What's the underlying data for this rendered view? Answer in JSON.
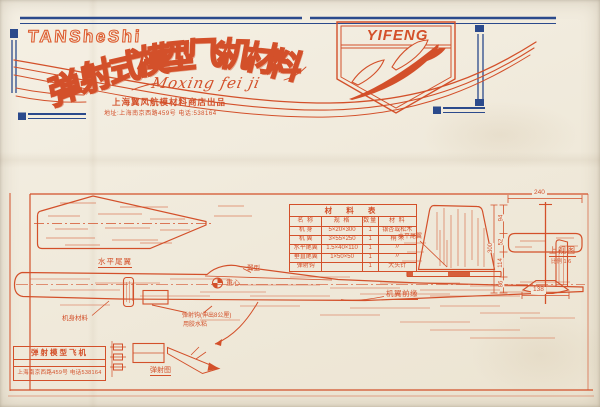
{
  "header": {
    "brand_latin": "TANSheShi",
    "title_cn": "弹射式模型飞机材料",
    "title_chars": [
      "弹",
      "射",
      "式",
      "模",
      "型",
      "飞",
      "机",
      "材",
      "料"
    ],
    "script_latin": "Moxing fei ji",
    "store_line": "上海翼风航模材料商店出品",
    "address_line": "地址:上海南京西路459号 电话:538164",
    "badge_brand": "YIFENG"
  },
  "materials_table": {
    "title": "材 料 表",
    "columns": [
      "名 称",
      "规 格",
      "数量",
      "材 料"
    ],
    "rows": [
      [
        "机 身",
        "5×20×300",
        "1",
        "银杏或松木"
      ],
      [
        "机 翼",
        "3×55×250",
        "1",
        "桐 木"
      ],
      [
        "水平尾翼",
        "1.5×40×110",
        "1",
        "〃"
      ],
      [
        "垂直尾翼",
        "1×50×50",
        "1",
        "〃"
      ],
      [
        "弹射钩",
        "",
        "1",
        "大头针"
      ]
    ]
  },
  "drawing": {
    "labels": {
      "stabilizer": "水平尾翼",
      "stab_edge": "水平尾翼",
      "airfoil": "翼型",
      "cg": "重心",
      "wing_leading_edge": "机翼前缘",
      "hook_line1": "弹射钩(伸出8公厘)",
      "hook_line2": "用胶水粘",
      "fuselage": "机身材料",
      "top_view": "上视图",
      "scale_note": "比例 1:6",
      "launch_diagram": "弹射图"
    },
    "dimensions": {
      "tail_span": "240",
      "stab_span": "138",
      "seg1": "94",
      "seg2": "52",
      "seg3": "114",
      "seg4": "86",
      "total_length": "300"
    }
  },
  "footer_box": {
    "line1": "弹射模型飞机",
    "line2": "上海南京西路459号 电话538164"
  },
  "colors": {
    "ink_orange": "#d3502a",
    "ink_blue": "#2b4a8c",
    "paper": "#f1ebdd"
  }
}
